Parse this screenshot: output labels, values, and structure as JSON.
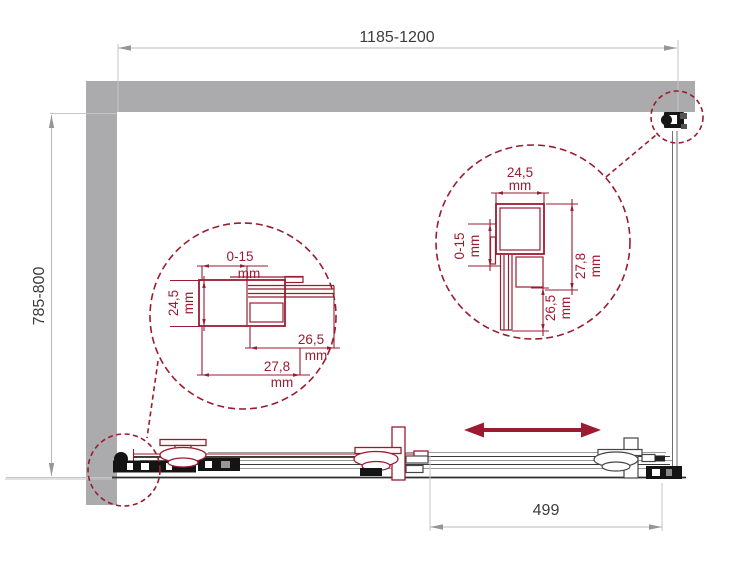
{
  "drawing": {
    "type": "shower-enclosure-installation-plan-top-view"
  },
  "colors": {
    "wall_gray": "#ababad",
    "accent_maroon": "#9b1b31",
    "dim_line_gray": "#b9b9bb",
    "dim_text_dark": "#3c3c3c",
    "hardware_black": "#141414"
  },
  "main_dimensions": {
    "top_width": "1185-1200",
    "left_depth": "785-800",
    "bottom_offset": "499"
  },
  "detail_left": {
    "adjust_range": "0-15",
    "profile_depth": "24,5",
    "inner_width": "26,5",
    "outer_width": "27,8"
  },
  "detail_right": {
    "profile_width": "24,5",
    "adjust_range": "0-15",
    "inner_depth": "26,5",
    "outer_depth": "27,8"
  },
  "units": {
    "mm": "mm"
  }
}
